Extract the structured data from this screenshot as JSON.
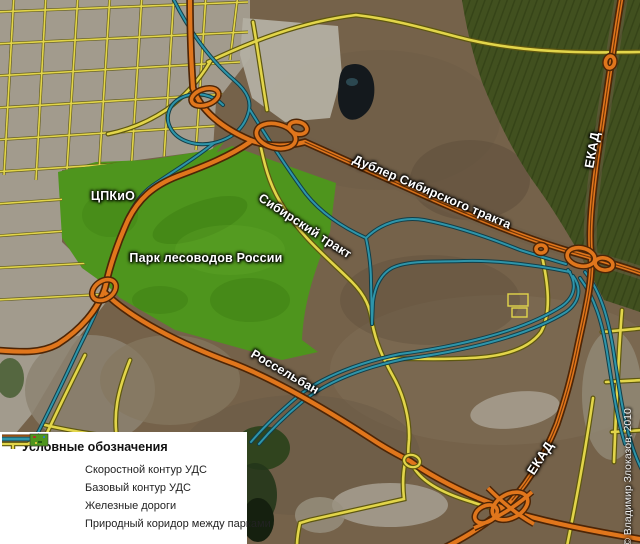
{
  "map": {
    "labels": {
      "cpkio": "ЦПКиО",
      "park_lesovodov": "Парк лесоводов России",
      "sibirsky": "Сибирский тракт",
      "dubler": "Дублер Сибирского тракта",
      "rosselban": "Россельбан",
      "ekad_top": "ЕКАД",
      "ekad_bottom": "ЕКАД"
    },
    "copyright": "© Владимир Злоказов, 2010"
  },
  "legend": {
    "title": "Условные обозначения",
    "items": [
      {
        "label": "Скоростной контур УДС"
      },
      {
        "label": "Базовый контур УДС"
      },
      {
        "label": "Железные дороги"
      },
      {
        "label": "Природный коридор между парками"
      }
    ]
  },
  "colors": {
    "speed_contour": "#e0761c",
    "base_contour": "#e2d54a",
    "railway": "#2e95aa",
    "park_green": "#4e951d"
  }
}
